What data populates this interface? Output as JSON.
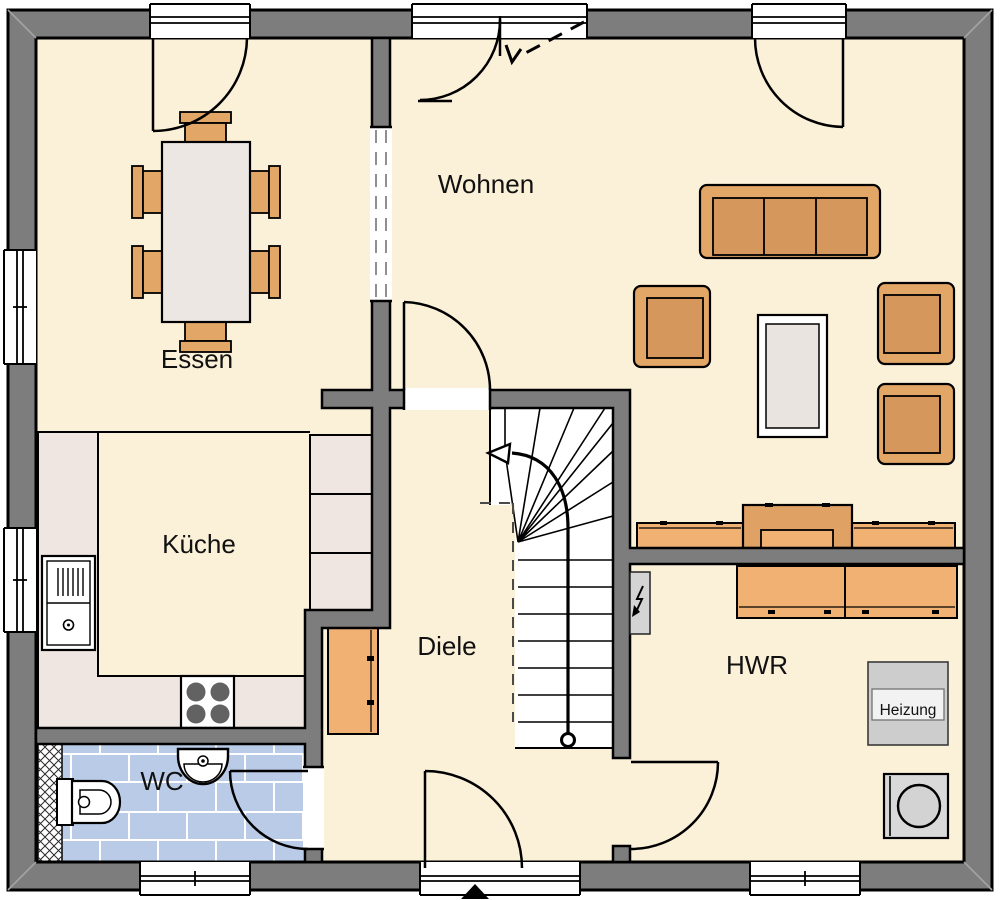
{
  "plan": {
    "type": "floor-plan-ground-floor",
    "rooms": [
      {
        "id": "essen",
        "label": "Essen"
      },
      {
        "id": "wohnen",
        "label": "Wohnen"
      },
      {
        "id": "kueche",
        "label": "Küche"
      },
      {
        "id": "diele",
        "label": "Diele"
      },
      {
        "id": "wc",
        "label": "WC"
      },
      {
        "id": "hwr",
        "label": "HWR"
      }
    ],
    "equipment": {
      "heizung_label": "Heizung"
    },
    "colors": {
      "wall": "#7D7D7D",
      "floor": "#FBF0D8",
      "wc_tile": "#B9CBE7",
      "counter": "#EFE6E1",
      "table": "#EDE7E3",
      "furniture_light": "#F0B173",
      "furniture_mid": "#E2A667",
      "furniture_seat": "#D6975C",
      "appliance_gray": "#CDCDCD",
      "outline": "#000000"
    }
  }
}
